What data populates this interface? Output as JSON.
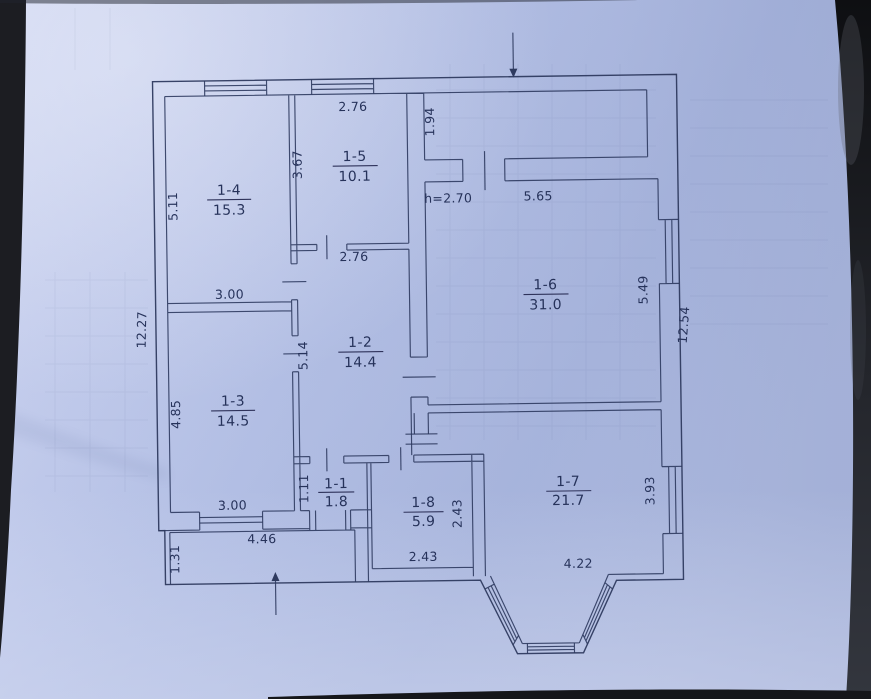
{
  "photo": {
    "paper_color": "#b9c3e6",
    "ink_color": "#2e3a5f",
    "backdrop_color": "#1a1b1f"
  },
  "plan": {
    "rooms": [
      {
        "id": "1-1",
        "area": "1.8"
      },
      {
        "id": "1-2",
        "area": "14.4"
      },
      {
        "id": "1-3",
        "area": "14.5"
      },
      {
        "id": "1-4",
        "area": "15.3"
      },
      {
        "id": "1-5",
        "area": "10.1"
      },
      {
        "id": "1-6",
        "area": "31.0"
      },
      {
        "id": "1-7",
        "area": "21.7"
      },
      {
        "id": "1-8",
        "area": "5.9"
      }
    ],
    "dims": {
      "room15_top": "2.76",
      "room15_left": "3.67",
      "room14_left": "5.11",
      "room14_bottom": "3.00",
      "vestibule_left": "1.94",
      "ceiling_height": "h=2.70",
      "room16_top": "5.65",
      "room16_right": "5.49",
      "right_wall_total": "12.54",
      "left_wall_total": "12.27",
      "room15_below": "2.76",
      "room12_left": "5.14",
      "room13_left": "4.85",
      "room13_bottom": "3.00",
      "room11_left": "1.11",
      "room18_right": "2.43",
      "room18_bottom": "2.43",
      "room17_bottom": "4.22",
      "room17_right": "3.93",
      "porch_top": "4.46",
      "porch_left": "1.31"
    }
  }
}
